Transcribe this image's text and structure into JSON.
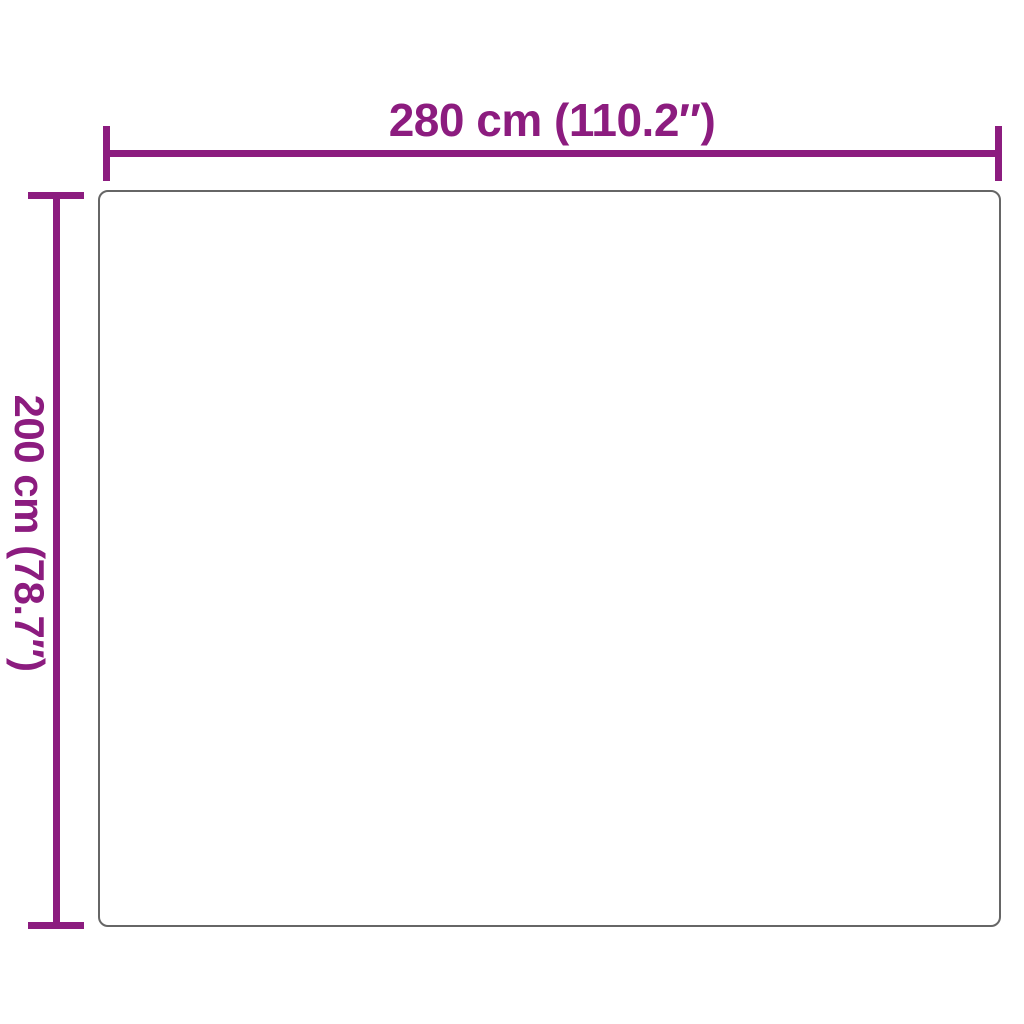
{
  "diagram": {
    "type": "product-dimension-diagram",
    "width_label": "280 cm (110.2″)",
    "height_label": "200 cm (78.7″)",
    "width": {
      "cm": "280",
      "inches": "110.2"
    },
    "height": {
      "cm": "200",
      "inches": "78.7"
    },
    "colors": {
      "dimension_accent": "#8C1C7F",
      "outline_border": "#666666",
      "background": "#FFFFFF"
    }
  }
}
